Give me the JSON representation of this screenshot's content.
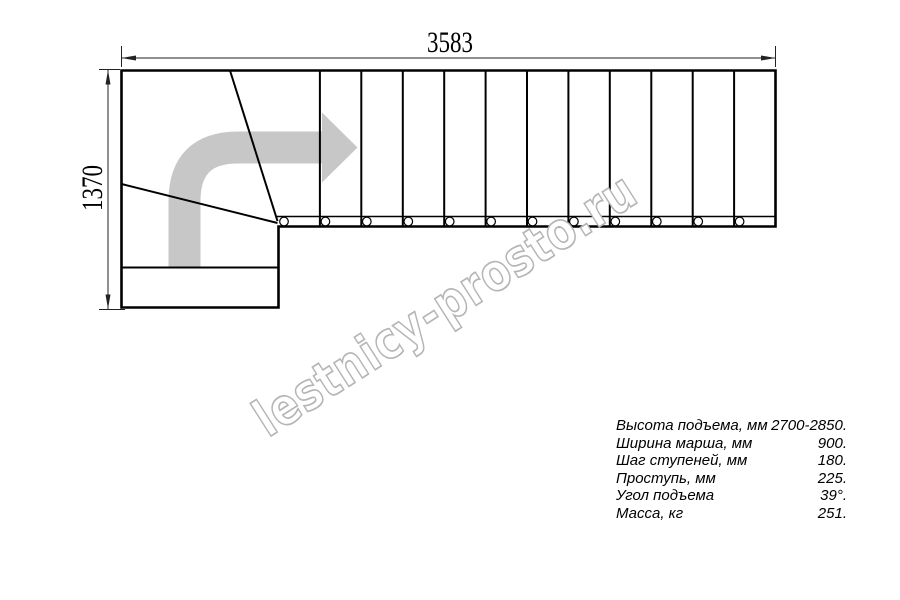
{
  "drawing": {
    "dimension_width_mm": "3583",
    "dimension_height_mm": "1370",
    "watermark": "lestnicy-prosto.ru",
    "stairs": {
      "straight_tread_count": 12,
      "baluster_count": 12
    },
    "colors": {
      "line": "#000000",
      "dimension": "#222222",
      "direction_arrow": "#c7c7c7",
      "watermark_outline": "#b5b5b5"
    }
  },
  "specs": {
    "rows": [
      {
        "label": "Высота подъема, мм",
        "value": "2700-2850."
      },
      {
        "label": "Ширина марша, мм",
        "value": "900."
      },
      {
        "label": "Шаг ступеней, мм",
        "value": "180."
      },
      {
        "label": "Проступь, мм",
        "value": "225."
      },
      {
        "label": "Угол подъема",
        "value": "39°."
      },
      {
        "label": "Масса, кг",
        "value": "251."
      }
    ]
  }
}
